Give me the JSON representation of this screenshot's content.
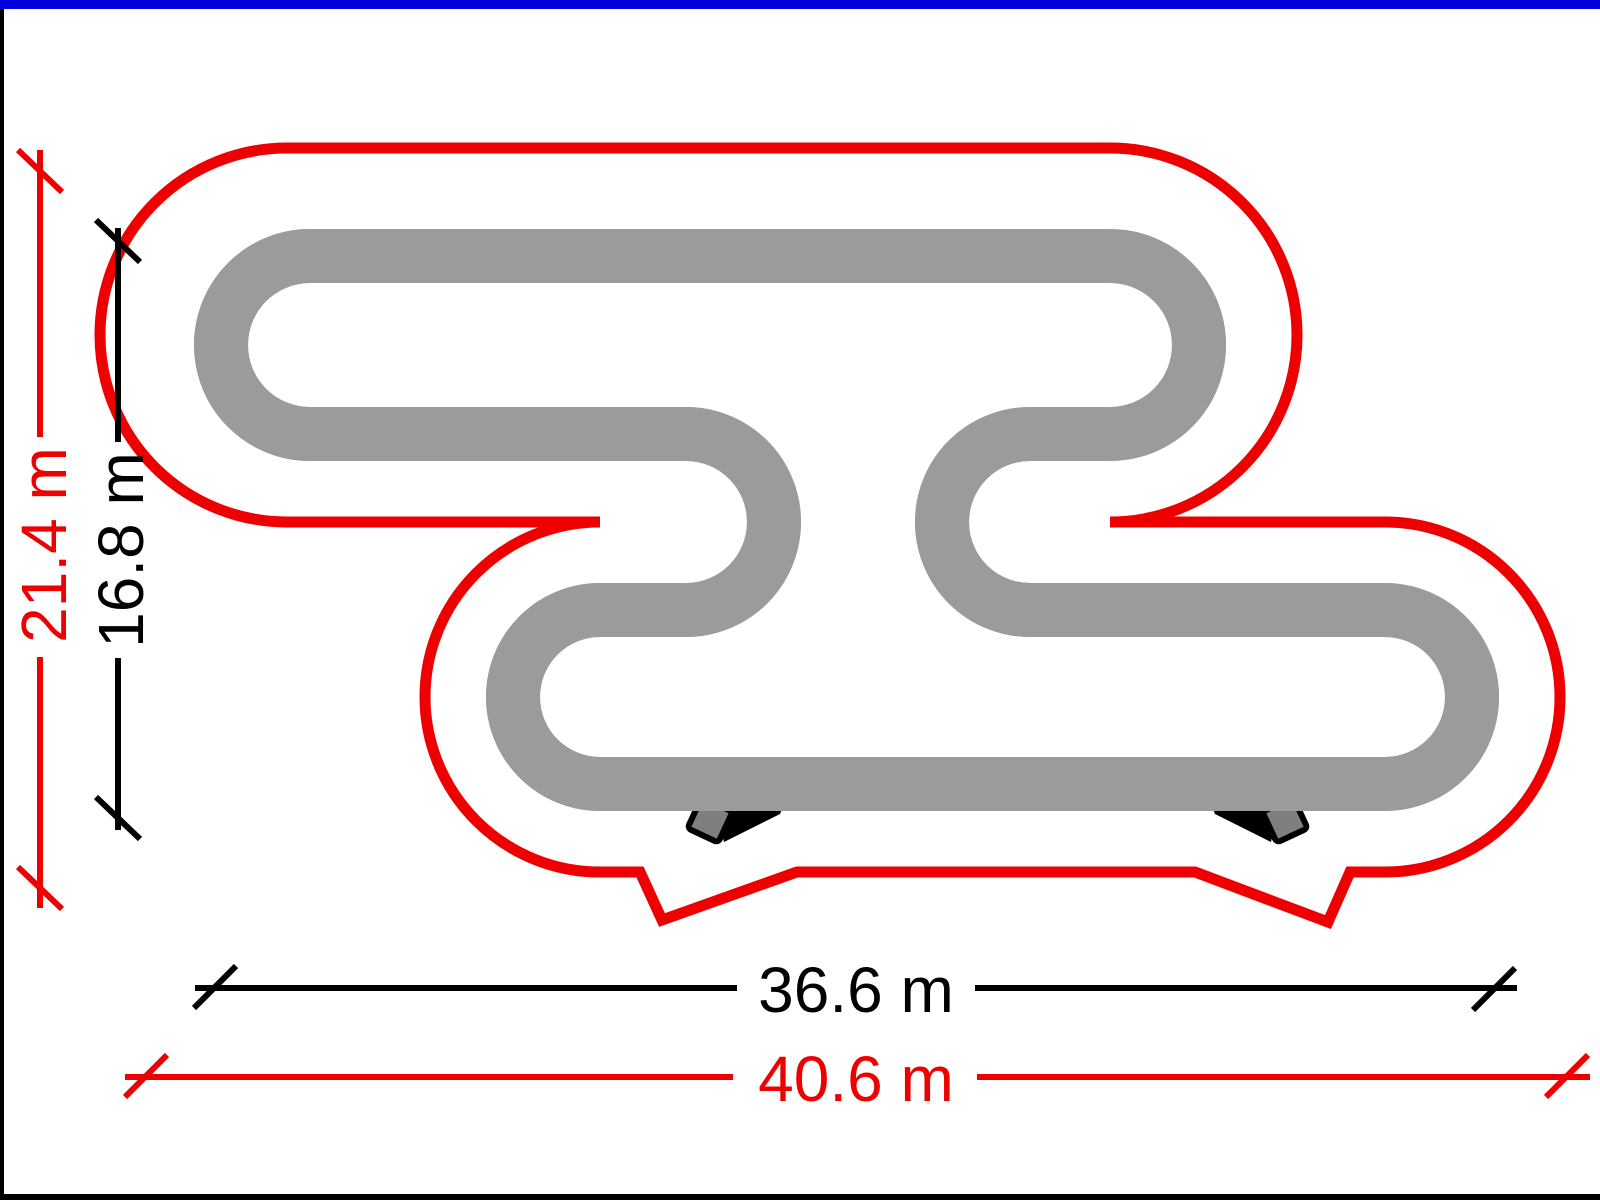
{
  "page": {
    "background": "#ffffff",
    "top_border_color": "#0000dd",
    "side_border_color": "#000000"
  },
  "diagram": {
    "colors": {
      "boundary": "#ee0000",
      "track_fill": "#000000",
      "track_edge": "#9b9b9b",
      "terminal": "#7f7f7f"
    },
    "dimensions": {
      "area_height": {
        "text": "21.4 m",
        "value": 21.4,
        "unit": "m",
        "color": "#ee0000",
        "orientation": "vertical"
      },
      "track_height": {
        "text": "16.8 m",
        "value": 16.8,
        "unit": "m",
        "color": "#000000",
        "orientation": "vertical"
      },
      "track_width": {
        "text": "36.6 m",
        "value": 36.6,
        "unit": "m",
        "color": "#000000",
        "orientation": "horizontal"
      },
      "area_width": {
        "text": "40.6 m",
        "value": 40.6,
        "unit": "m",
        "color": "#ee0000",
        "orientation": "horizontal"
      }
    }
  }
}
